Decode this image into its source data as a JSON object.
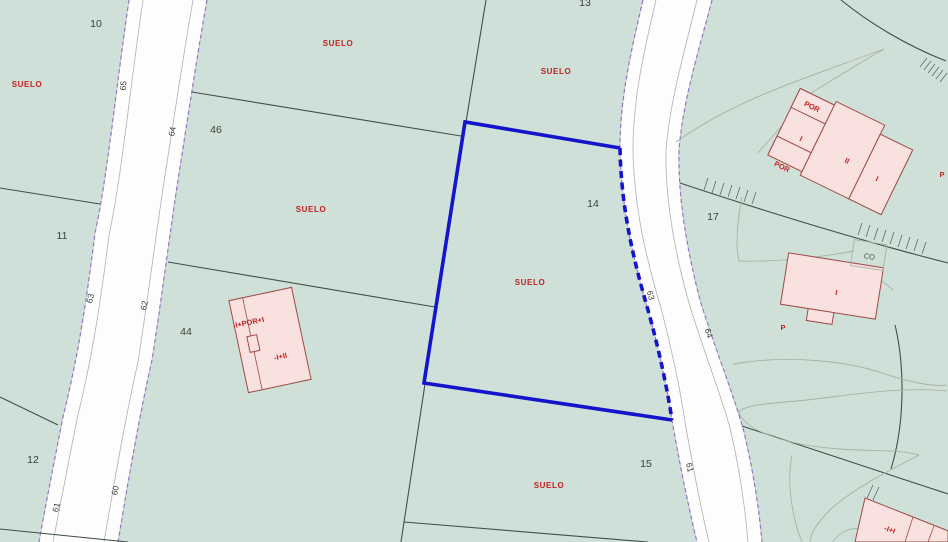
{
  "colors": {
    "map-green": "#cfe0d8",
    "road-white": "#fdfdfd",
    "edge-purple": "#8a68c0",
    "boundary-dark": "#41514a",
    "contour-gray": "#a8b2aa",
    "selection-blue": "#1414cc",
    "building-pink": "#f8e1df",
    "building-red": "#9e4a44",
    "label-red": "#c32222",
    "number-dark": "#38413b"
  },
  "labels": {
    "parcel_numbers": [
      "10",
      "13",
      "46",
      "11",
      "44",
      "12",
      "14",
      "17",
      "15"
    ],
    "suelo": [
      "SUELO",
      "SUELO",
      "SUELO",
      "SUELO",
      "SUELO",
      "SUELO"
    ],
    "street_numbers_left": [
      "65",
      "64",
      "63",
      "62",
      "61",
      "60"
    ],
    "street_numbers_right": [
      "63",
      "64",
      "61"
    ],
    "building_floor_labels": {
      "top_right_por_upper": "POR",
      "top_right_i_left": "I",
      "top_right_por_lower": "POR",
      "top_right_ii": "II",
      "top_right_i_right": "I",
      "mid_right_i": "I",
      "co": "CO",
      "p_mid": "P",
      "p_edge": "P",
      "left_building_upper": "-I+POR+I",
      "left_building_lower": "-I+II",
      "bottom_right": "-I+I"
    }
  }
}
